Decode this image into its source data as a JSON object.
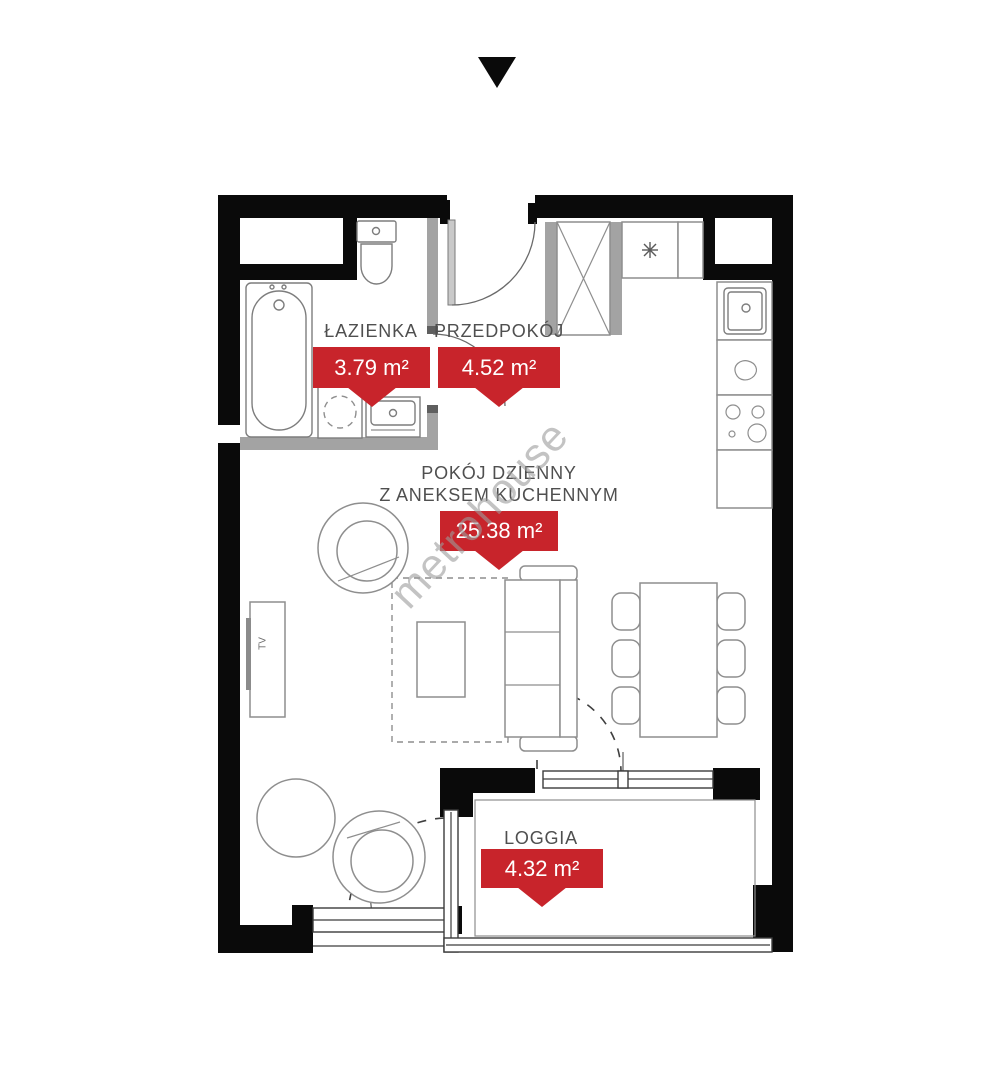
{
  "marker": {
    "icon": "triangle-down"
  },
  "watermark": {
    "text": "metrohouse"
  },
  "rooms": [
    {
      "name": "ŁAZIENKA",
      "area": "3.79 m²"
    },
    {
      "name": "PRZEDPOKÓJ",
      "area": "4.52 m²"
    },
    {
      "name_line1": "POKÓJ DZIENNY",
      "name_line2": "Z ANEKSEM KUCHENNYM",
      "area": "25.38 m²"
    },
    {
      "name": "LOGGIA",
      "area": "4.32 m²"
    }
  ],
  "furniture_labels": {
    "tv": "TV"
  },
  "colors": {
    "wall_black": "#0a0a0a",
    "partition_gray": "#a3a3a3",
    "partition_dark": "#5f5f5f",
    "line_gray": "#8e8e8e",
    "label_gray": "#4f4f4f",
    "tag_red": "#c8242b",
    "watermark_gray": "#9c9c9c"
  }
}
